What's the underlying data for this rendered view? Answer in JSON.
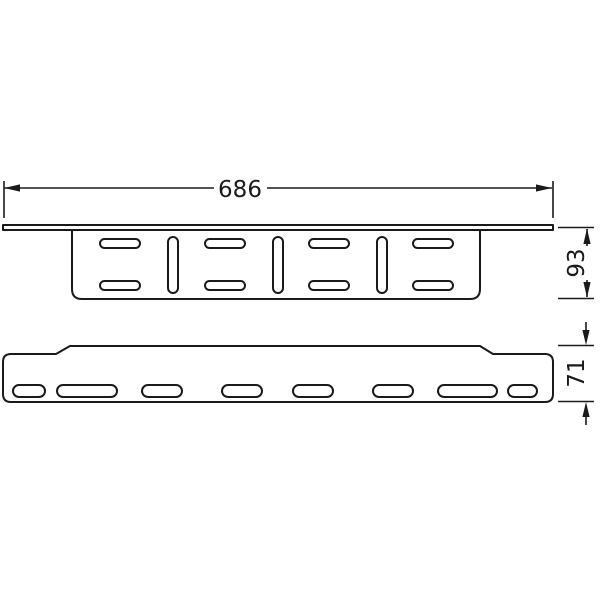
{
  "colors": {
    "line": "#1a1a1a",
    "background": "#ffffff"
  },
  "dimensions": {
    "overall_width": "686",
    "upper_view_height": "93",
    "lower_view_height": "71"
  }
}
